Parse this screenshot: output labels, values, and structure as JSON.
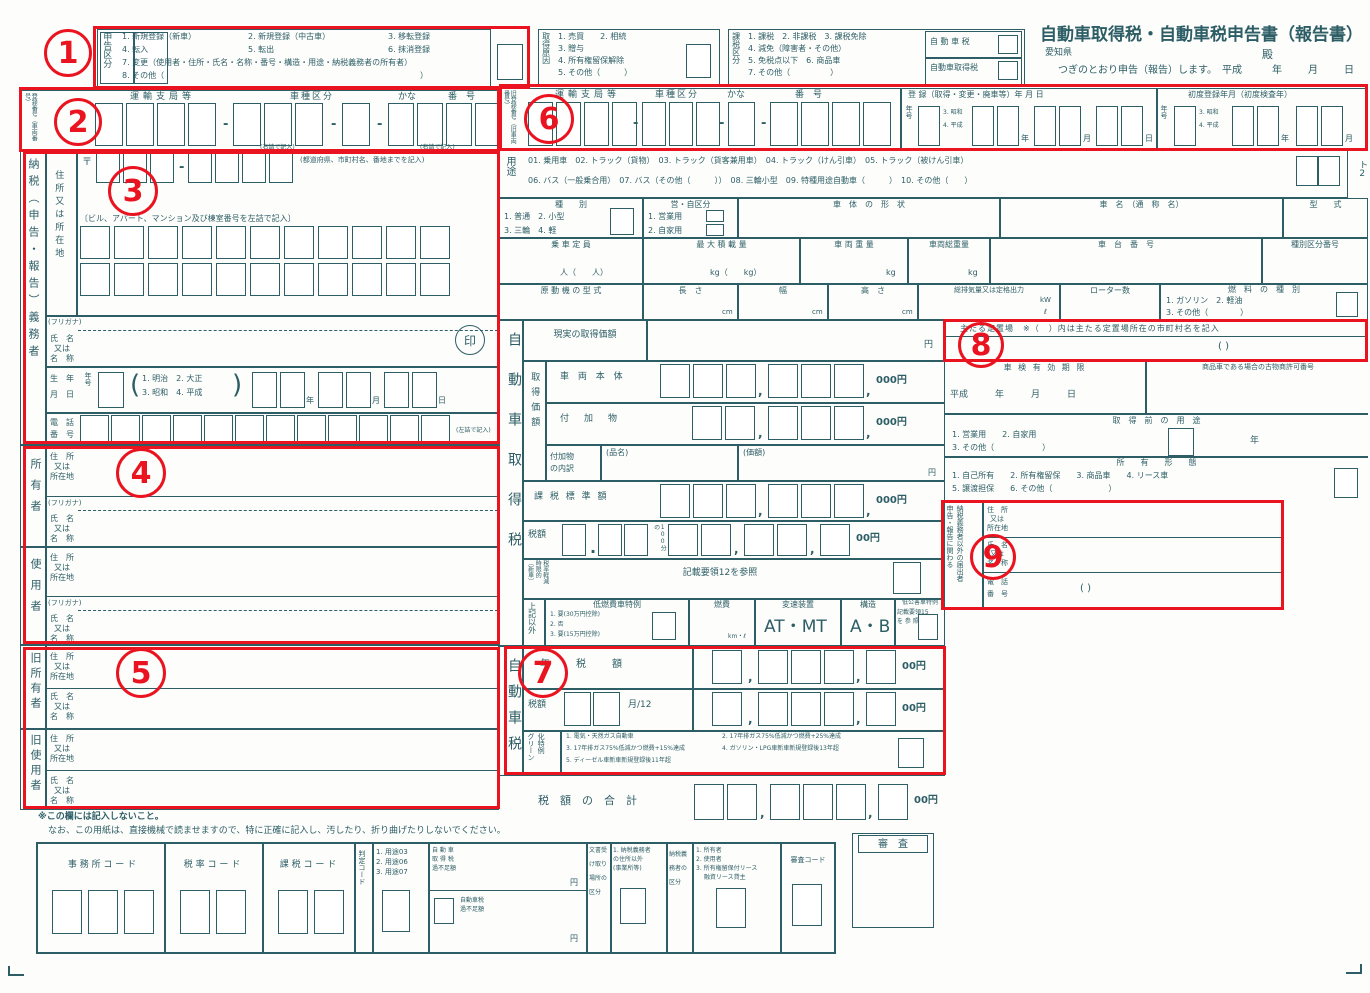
{
  "colors": {
    "ink": "#2d5e66",
    "red": "#ea1420"
  },
  "ann": {
    "n1": "1",
    "n2": "2",
    "n3": "3",
    "n4": "4",
    "n5": "5",
    "n6": "6",
    "n7": "7",
    "n8": "8",
    "n9": "9"
  },
  "misc": {
    "dash": "-",
    "comma": ",",
    "period": ".",
    "yen": "円",
    "yen000": "000円",
    "yen00": "00円",
    "lp": "(",
    "rp": ")",
    "paren_blank": "(                    )",
    "tel_paren": "(              )"
  },
  "header": {
    "title": "自動車取得税・自動車税申告書（報告書）",
    "prefecture": "愛知県",
    "dono": "殿",
    "declare": "つぎのとおり申告（報告）します。",
    "era": "平成",
    "y": "年",
    "m": "月",
    "d": "日"
  },
  "sk": {
    "label": "申告区分",
    "i1": "1. 新規登録（新車）",
    "i2": "2. 新規登録（中古車）",
    "i3": "3. 移転登録",
    "i4": "4. 転入",
    "i5": "5. 転出",
    "i6": "6. 抹消登録",
    "i7": "7. 変更（使用者・住所・氏名・名称・番号・構造・用途・納税義務者の所有者）",
    "i8": "8. その他（",
    "i8e": "）"
  },
  "gen": {
    "label": "取得原因",
    "i12": "1. 売買　　2. 相続",
    "i3": "3. 贈与",
    "i4": "4. 所有権留保解除",
    "i5": "5. その他（　　　）"
  },
  "kz": {
    "label": "課税区分",
    "i1": "1. 課税　2. 非課税　3. 課税免除",
    "i4": "4. 減免（障害者・その他）",
    "i56": "5. 免税点以下　6. 商品車",
    "i7": "7. その他（　　　　　）",
    "t1": "自 動 車 税",
    "t2": "自動車取得税"
  },
  "reg": {
    "label": "登録番号（車両番号）",
    "label_old": "旧登録番号（旧車両番号）",
    "unyu": "運輸支局等",
    "shashu": "車種区分",
    "kana": "かな",
    "no": "番　号",
    "note": "(右詰で記入)"
  },
  "regdate": {
    "h": "登 録（取得・変更・廃車等）年 月 日",
    "gengo": "年号",
    "g3": "3. 昭和",
    "g4": "4. 平成",
    "y": "年",
    "m": "月",
    "d": "日"
  },
  "first": {
    "h": "初度登録年月（初度検査年）"
  },
  "yoto": {
    "label": "用途",
    "l1": "01. 乗用車　02. トラック（貨物）　03. トラック（貨客兼用車）　04. トラック（けん引車）　05. トラック（被けん引車）",
    "l2": "06. バス（一般乗合用）　07. バス（その他（　　　））　08. 三輪小型　09. 特種用途自動車（　　　）　10. その他（　　）",
    "mark": "ト2"
  },
  "shubetsu": {
    "h": "種　　別",
    "l1": "1. 普通　2. 小型",
    "l2": "3. 三輪　4. 軽"
  },
  "eiji": {
    "h": "営・自区分",
    "l1": "1. 営業用",
    "l2": "2. 自家用"
  },
  "shatai": {
    "h": "車　体　の　形　状"
  },
  "shamei": {
    "h": "車　名　（通　称　名）"
  },
  "katashiki": {
    "h": "型　　式"
  },
  "teiin": {
    "h": "乗 車 定 員",
    "u": "人（　　人）"
  },
  "saidai": {
    "h": "最 大 積 載 量",
    "u": "kg（　　kg）"
  },
  "juryo": {
    "h": "車 両 重 量",
    "u": "kg"
  },
  "sojuryo": {
    "h": "車両総重量",
    "u": "kg"
  },
  "shadai": {
    "h": "車　台　番　号"
  },
  "kubun_no": {
    "h": "種別区分番号"
  },
  "gendoki": {
    "h": "原 動 機 の 型 式"
  },
  "nagasa": {
    "h": "長　さ",
    "u": "cm"
  },
  "haba": {
    "h": "幅",
    "u": "cm"
  },
  "takasa": {
    "h": "高　さ",
    "u": "cm"
  },
  "haiki": {
    "h": "総排気量又は定格出力",
    "u1": "kW",
    "u2": "ℓ"
  },
  "rotor": {
    "h": "ローター数"
  },
  "nenryo": {
    "h": "燃　料　の　種　別",
    "l1": "1. ガソリン　2. 軽油",
    "l2": "3. その他（　　　　）"
  },
  "nozei": {
    "label": "納税（申告・報告）義務者",
    "jusho": "住所又は所在地",
    "mark": "〒",
    "addr_note": "(都道府県、市町村名、番地までを記入)",
    "bldg_note": "〔ビル、アパート、マンション及び棟室番号を左詰で記入〕",
    "furigana": "(フリガナ)",
    "shimei": "氏名又は名称",
    "in": "印",
    "birth1": "生　年",
    "birth2": "月　日",
    "gengo": "年号",
    "gn1": "1. 明治　2. 大正",
    "gn2": "3. 昭和　4. 平成",
    "y": "年",
    "m": "月",
    "d": "日",
    "tel1": "電　話",
    "tel2": "番　号",
    "tel_note": "(左詰で記入)"
  },
  "shoyusha": {
    "label": "所有者",
    "jusho": "住 所\n又は\n所在地",
    "furigana": "(フリガナ)",
    "shimei": "氏 名\n又は\n名 称"
  },
  "shiyosha": {
    "label": "使用者"
  },
  "kyusho": {
    "label": "旧所有者"
  },
  "kyushi": {
    "label": "旧使用者"
  },
  "lblparts": {
    "j1": "住　所",
    "j2": "又は",
    "j3": "所在地",
    "s1": "氏　名",
    "s2": "又は",
    "s3": "名　称"
  },
  "szei": {
    "label": "自動車取得税",
    "genjitsu": "現実の取得価額",
    "kakaku": "取得価額",
    "hontai": "車 両 本 体",
    "fuka": "付　加　物",
    "uchiwake1": "付加物",
    "uchiwake2": "の内訳",
    "hinmei": "(品名)",
    "kagaku": "(価額)",
    "hyojun": "課 税 標 準 額",
    "zeigaku": "税額",
    "bunno": "100分の",
    "keigen1": "〔新車〕",
    "keigen2": "時限的",
    "keigen3": "税率軽減",
    "kisai12": "記載要領12を参照",
    "jokigai": "上記以外",
    "tei_h": "低燃費車特例",
    "tei1": "1. 要(30万円控除)",
    "tei2": "2. 否",
    "tei3": "3. 要(15万円控除)",
    "nenpi_h": "燃費",
    "nenpi_u": "km・ℓ",
    "hensoku_h": "変速装置",
    "hensoku": "AT・MT",
    "kozo_h": "構造",
    "kozo": "A・B",
    "kogai_h": "低公害車特例",
    "kisai15a": "記載要領15",
    "kisai15b": "を 参 照"
  },
  "jzei": {
    "label": "自動車税",
    "nenzei": "年　税　額",
    "zeigaku": "税額",
    "t12": "月/12",
    "g1": "グリーン",
    "g2": "化特例",
    "gi1": "1. 電気・天然ガス自動車",
    "gi2": "2. 17年排ガス75%低減かつ燃費+25%達成",
    "gi3": "3. 17年排ガス75%低減かつ燃費+15%達成",
    "gi4": "4. ガソリン・LPG車新車新規登録後13年超",
    "gi5": "5. ディーゼル車新車新規登録後11年超"
  },
  "gokei": {
    "label": "税　額　の　合　計"
  },
  "teichiba": {
    "h": "主たる定置場　※（　）内は主たる定置場所在の市町村名を記入"
  },
  "shaken": {
    "h": "車 検 有 効 期 限",
    "c": "平成　　　年　　　月　　　日"
  },
  "kobutsu": {
    "h": "商品車である場合の古物商許可番号"
  },
  "mae": {
    "h": "取　得　前　の　用　途",
    "l1": "1. 営業用　　2. 自家用",
    "l2": "3. その他（　　　　　　）",
    "nen": "年"
  },
  "keitai": {
    "h": "所　　有　　形　　態",
    "l1": "1. 自己所有　　2. 所有権留保　　3. 商品車　　4. リース車",
    "l2": "5. 譲渡担保　　6. その他（　　　　　　　）"
  },
  "todokede": {
    "label1": "申告・報告に関わる",
    "label2": "納税義務者以外の届出者",
    "tel1": "電　話",
    "tel2": "番　号"
  },
  "notes": {
    "n1": "※この欄には記入しないこと。",
    "n2": "なお、この用紙は、直接機械で読ませますので、特に正確に記入し、汚したり、折り曲げたりしないでください。"
  },
  "codes": {
    "jimusho": "事 務 所 コ ー ド",
    "zeiritsu": "税 率 コ ー ド",
    "kazei": "課 税 コ ー ド",
    "hantei": "判定コード",
    "h1": "1. 用途03",
    "h2": "2. 用途06",
    "h3": "3. 用途07",
    "kfs1a": "自 動 車",
    "kfs1b": "取 得 税",
    "kfs1c": "過不足額",
    "kfs2a": "自動車税",
    "kfs2b": "過不足額",
    "bunsho1": "文書受",
    "bunsho2": "け取り",
    "bunsho3": "場所の",
    "bunsho4": "区分",
    "b1a": "1. 納税義務者",
    "b1b": "の住所以外",
    "b1c": "(事業所等)",
    "aten1": "納税義",
    "aten2": "務者の",
    "aten3": "区分",
    "a1": "1. 所有者",
    "a2": "2. 使用者",
    "a3": "3. 所有権留保付リース",
    "a4": "　 融資リース貸主",
    "shinsa_code": "審査コード",
    "shinsa": "審　査"
  }
}
